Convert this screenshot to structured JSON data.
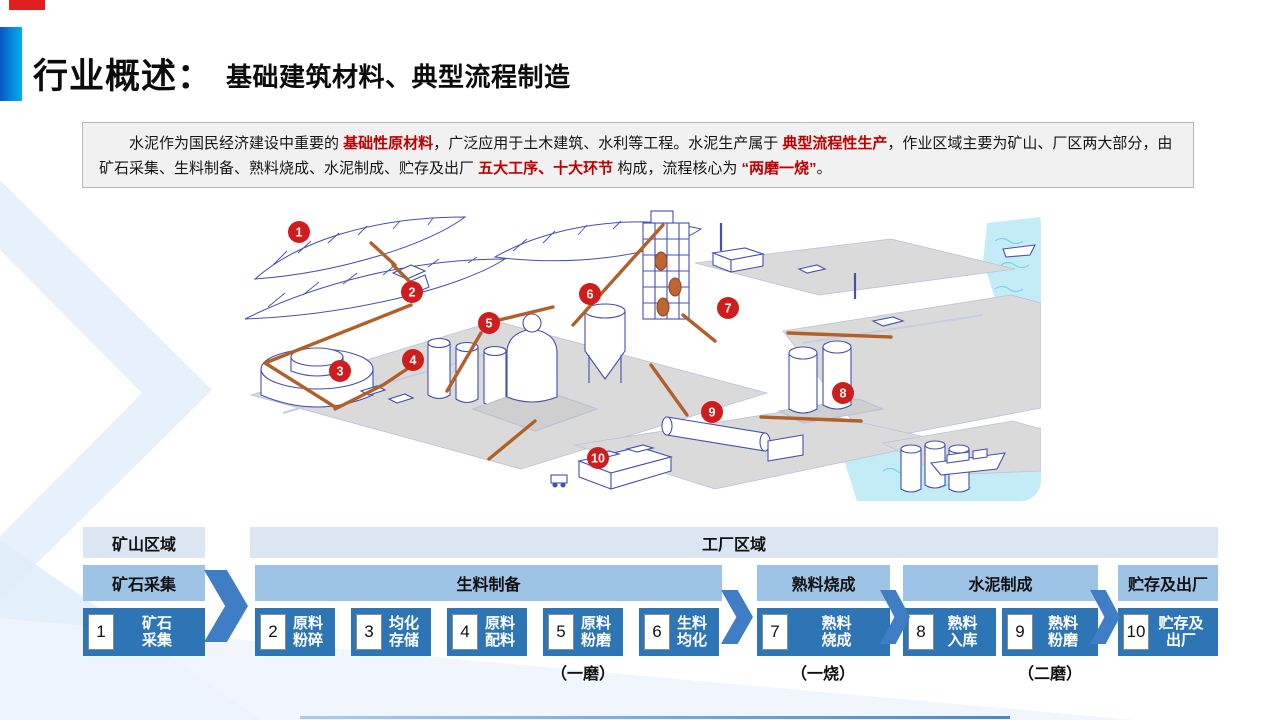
{
  "slide": {
    "title": "行业概述：",
    "subtitle": "基础建筑材料、典型流程制造"
  },
  "intro": {
    "runs": [
      {
        "text": "水泥作为国民经济建设中重要的 ",
        "red": false
      },
      {
        "text": "基础性原材料",
        "red": true
      },
      {
        "text": "，广泛应用于土木建筑、水利等工程。水泥生产属于 ",
        "red": false
      },
      {
        "text": "典型流程性生产",
        "red": true
      },
      {
        "text": "，作业区域主要为矿山、厂区两大部分，由矿石采集、生料制备、熟料烧成、水泥制成、贮存及出厂 ",
        "red": false
      },
      {
        "text": "五大工序、十大环节",
        "red": true
      },
      {
        "text": " 构成，流程核心为 ",
        "red": false
      },
      {
        "text": "“两磨一烧”",
        "red": true
      },
      {
        "text": "。",
        "red": false
      }
    ]
  },
  "diagram": {
    "marker_color": "#cf1d1d",
    "markers": [
      {
        "n": "1",
        "x": 56,
        "y": 29
      },
      {
        "n": "2",
        "x": 169,
        "y": 89
      },
      {
        "n": "3",
        "x": 97,
        "y": 168
      },
      {
        "n": "4",
        "x": 170,
        "y": 157
      },
      {
        "n": "5",
        "x": 246,
        "y": 120
      },
      {
        "n": "6",
        "x": 347,
        "y": 91
      },
      {
        "n": "7",
        "x": 485,
        "y": 105
      },
      {
        "n": "8",
        "x": 600,
        "y": 190
      },
      {
        "n": "9",
        "x": 469,
        "y": 209
      },
      {
        "n": "10",
        "x": 355,
        "y": 255
      }
    ]
  },
  "flow": {
    "colors": {
      "region_bg": "#dce6f2",
      "stage_bg": "#9dc3e6",
      "step_bg": "#2e75b6",
      "chevron": "#3f7dc4"
    },
    "regions": [
      {
        "label": "矿山区域",
        "x": 83,
        "w": 122
      },
      {
        "label": "工厂区域",
        "x": 250,
        "w": 968
      }
    ],
    "stages": [
      {
        "label": "矿石采集",
        "x": 83,
        "w": 122
      },
      {
        "label": "生料制备",
        "x": 255,
        "w": 467
      },
      {
        "label": "熟料烧成",
        "x": 757,
        "w": 133
      },
      {
        "label": "水泥制成",
        "x": 903,
        "w": 195
      },
      {
        "label": "贮存及出厂",
        "x": 1118,
        "w": 100
      }
    ],
    "steps": [
      {
        "num": "1",
        "line1": "矿石",
        "line2": "采集",
        "x": 83,
        "w": 122
      },
      {
        "num": "2",
        "line1": "原料",
        "line2": "粉碎",
        "x": 255,
        "w": 80
      },
      {
        "num": "3",
        "line1": "均化",
        "line2": "存储",
        "x": 351,
        "w": 80
      },
      {
        "num": "4",
        "line1": "原料",
        "line2": "配料",
        "x": 447,
        "w": 80
      },
      {
        "num": "5",
        "line1": "原料",
        "line2": "粉磨",
        "x": 543,
        "w": 80
      },
      {
        "num": "6",
        "line1": "生料",
        "line2": "均化",
        "x": 639,
        "w": 80
      },
      {
        "num": "7",
        "line1": "熟料",
        "line2": "烧成",
        "x": 757,
        "w": 133
      },
      {
        "num": "8",
        "line1": "熟料",
        "line2": "入库",
        "x": 903,
        "w": 93
      },
      {
        "num": "9",
        "line1": "熟料",
        "line2": "粉磨",
        "x": 1002,
        "w": 96
      },
      {
        "num": "10",
        "line1": "贮存及",
        "line2": "出厂",
        "x": 1118,
        "w": 100
      }
    ],
    "notes": [
      {
        "text": "（一磨）",
        "cx": 583
      },
      {
        "text": "（一烧）",
        "cx": 823
      },
      {
        "text": "（二磨）",
        "cx": 1050
      }
    ]
  }
}
